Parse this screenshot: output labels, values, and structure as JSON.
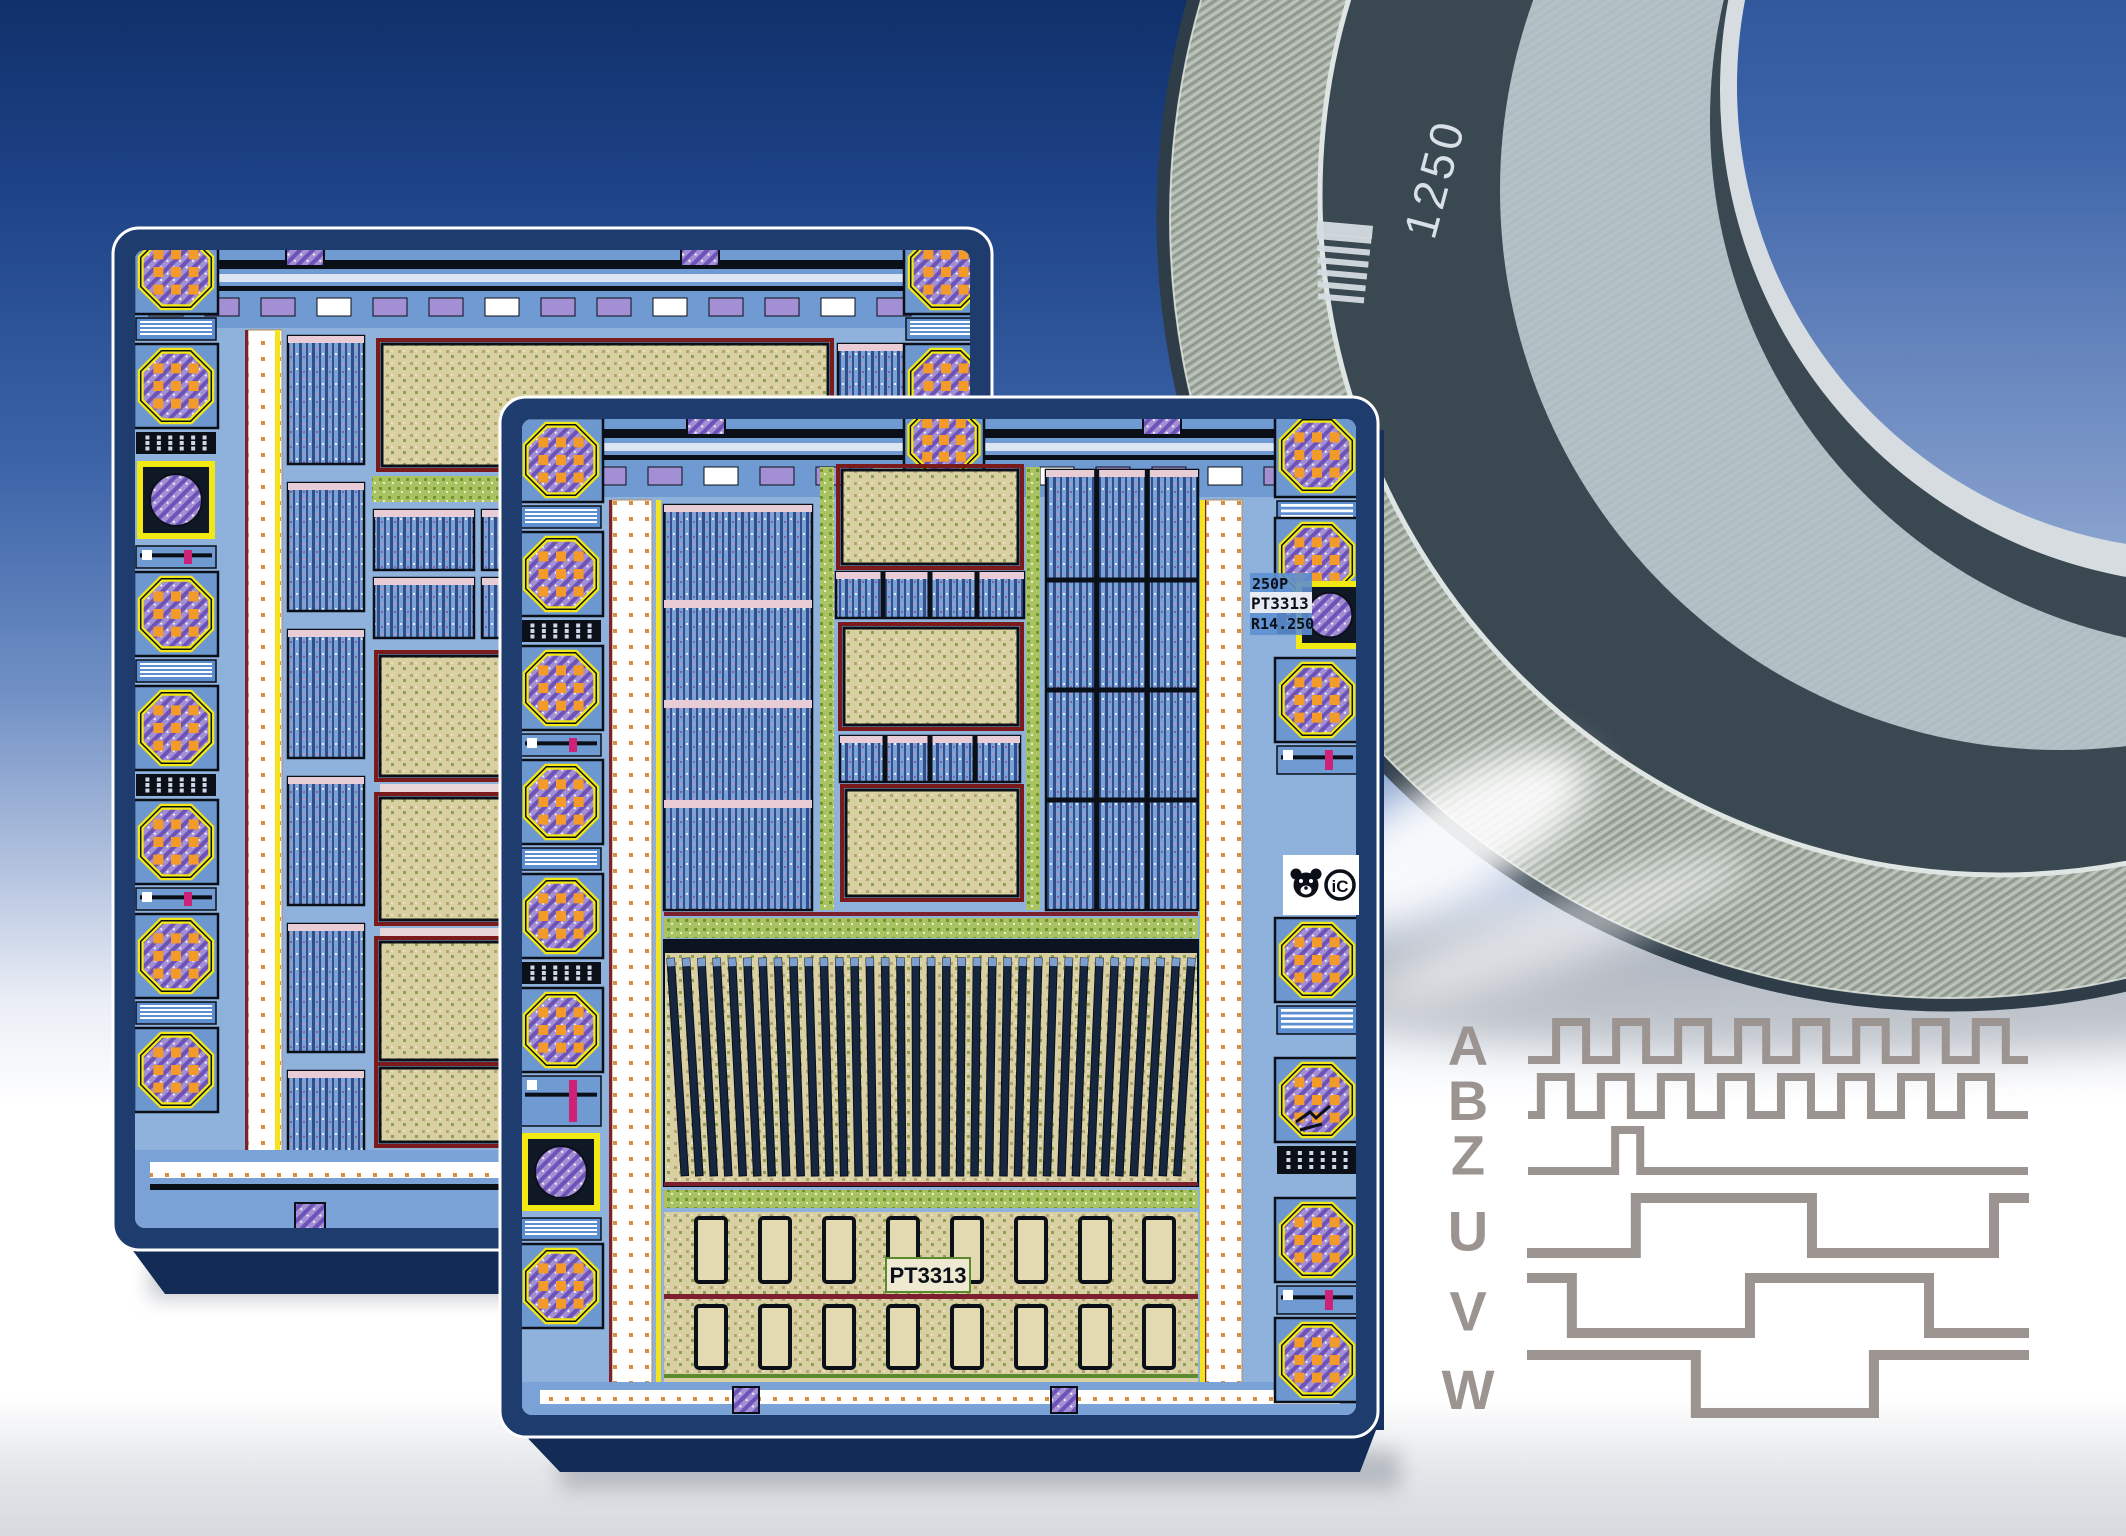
{
  "scene": {
    "description": "Promotional composite: two encoder ASIC die layouts, optical code disc, and encoder output timing diagram",
    "background": {
      "sky_top": "#10306a",
      "sky_mid": "#3c63a8",
      "sky_lower": "#b6c5e0",
      "floor": "#ffffff",
      "floor_shade": "#d6d9dd"
    }
  },
  "disc": {
    "label": "optical encoder code disc",
    "marking": "1250",
    "marking_color": "#d9e0e7",
    "barcode_bar_count": 7,
    "colors": {
      "band_dark": "#3a4852",
      "band_light": "#b3c1c9",
      "hub_pale": "#d6dce0",
      "track_base": "#a9b2a9",
      "track_line": "#8a948a",
      "track_line_light": "#c6ccc2",
      "rim_edge": "#2f3d49",
      "bright_ring": "#dfe5e2",
      "hole_top": "#1a3d80",
      "hole_bottom": "#7f97c5"
    }
  },
  "chips": {
    "front": {
      "bottom_label": "PT3313",
      "id_block": [
        "250P",
        "PT3313",
        "R14.250"
      ],
      "logos": {
        "bear": "bear-logo",
        "ic_text": "iC"
      }
    },
    "back": {
      "bottom_label": "",
      "id_block": []
    }
  },
  "palette": {
    "navy": "#1e3c6e",
    "navy_dark": "#132c55",
    "navy_side": "#16315f",
    "die_base": "#8fb2dc",
    "circuit_blue": "#6f9ad2",
    "circuit_deep": "#3c6db5",
    "black": "#0b0f18",
    "pad_yellow": "#f2e813",
    "pad_purple": "#a38fd4",
    "pad_hatch": "#6d53b8",
    "pad_orange": "#f29a2a",
    "tan": "#d8cfa2",
    "tan_dot": "#b5a36b",
    "tan_border": "#7a1a1a",
    "green": "#a9c262",
    "green_dot": "#6f9630",
    "stripe_base": "#7ba2d6",
    "stripe_dark": "#2f4e8a",
    "stripe_pink": "#c98fb4",
    "channel_dot": "#d88f3f",
    "yellow_line": "#f4e41d",
    "maroon": "#7c2030",
    "array_stripe": "#16263f",
    "array_cap": "#0c1422",
    "shadow": "#9aa0a8"
  },
  "chart_data": {
    "type": "digital-timing",
    "title": "Incremental encoder output signals",
    "x_axis": {
      "unit": "time",
      "range_pct": [
        0,
        100
      ]
    },
    "legend_position": "labels left of traces",
    "signal_color": "#9b9490",
    "signals": [
      {
        "label": "A",
        "start_level": 0,
        "edges_pct": [
          4.9,
          11,
          17.1,
          23.2,
          29.7,
          35.8,
          41.9,
          47.6,
          53.7,
          59.8,
          65.9,
          71.9,
          78,
          84.1,
          90.2,
          96.3
        ]
      },
      {
        "label": "B",
        "start_level": 0,
        "edges_pct": [
          1.8,
          7.9,
          14,
          20.1,
          26.2,
          32.3,
          38.4,
          44.5,
          50.6,
          56.7,
          62.8,
          68.9,
          75,
          81.1,
          87.2,
          93.3
        ]
      },
      {
        "label": "Z",
        "start_level": 0,
        "edges_pct": [
          16.9,
          22
        ]
      },
      {
        "label": "U",
        "start_level": 0,
        "edges_pct": [
          21.1,
          56.9,
          93.9
        ]
      },
      {
        "label": "V",
        "start_level": 1,
        "edges_pct": [
          8.1,
          44.3,
          80.7
        ]
      },
      {
        "label": "W",
        "start_level": 1,
        "edges_pct": [
          33.3,
          69.5
        ]
      }
    ]
  }
}
